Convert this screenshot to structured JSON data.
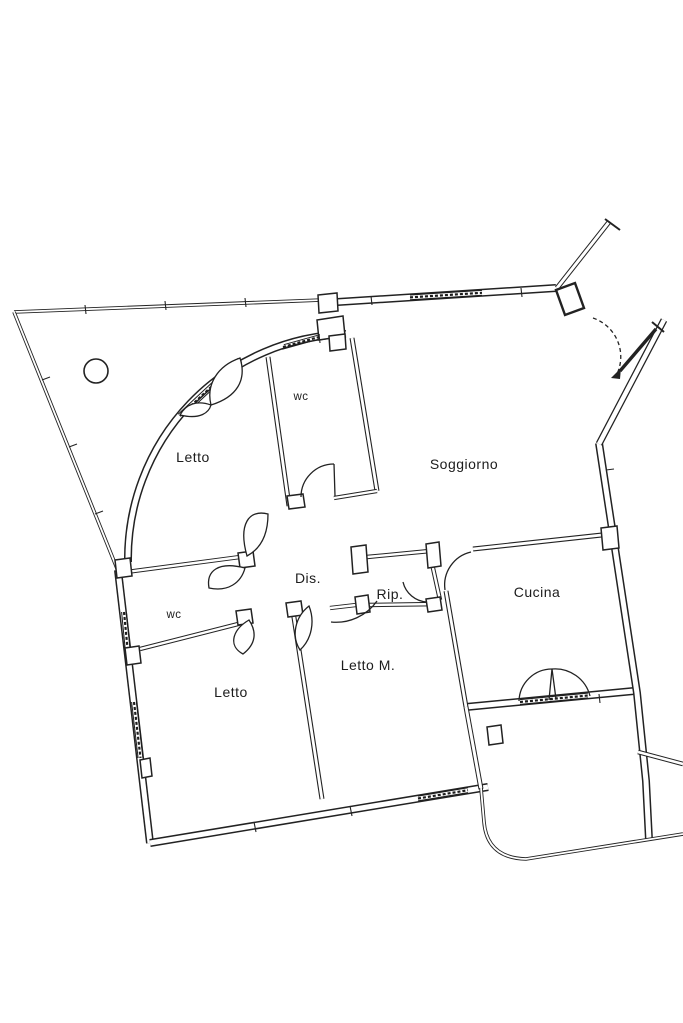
{
  "plan": {
    "type": "apartment-floor-plan",
    "rooms": {
      "letto_top": {
        "label": "Letto"
      },
      "wc_top": {
        "label": "wc"
      },
      "soggiorno": {
        "label": "Soggiorno"
      },
      "dis": {
        "label": "Dis."
      },
      "rip": {
        "label": "Rip."
      },
      "cucina": {
        "label": "Cucina"
      },
      "wc_low": {
        "label": "wc"
      },
      "letto_low": {
        "label": "Letto"
      },
      "letto_m": {
        "label": "Letto M."
      }
    },
    "colors": {
      "line": "#222222",
      "background": "#ffffff"
    }
  }
}
